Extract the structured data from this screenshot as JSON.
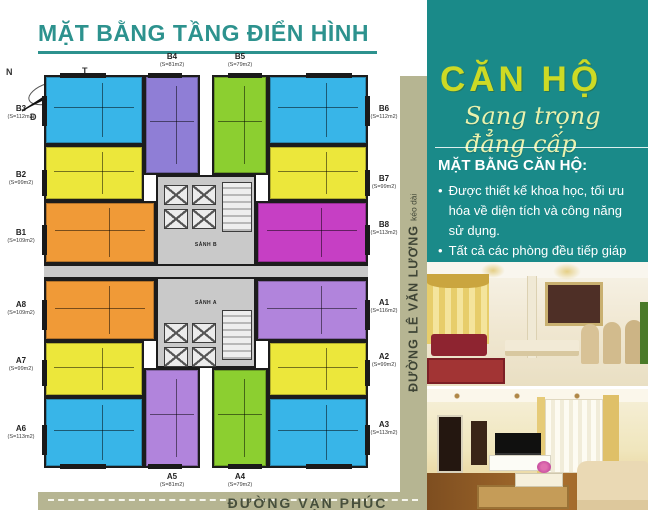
{
  "title": "MẶT BẰNG TẦNG ĐIỂN HÌNH",
  "compass": {
    "top_left": "N",
    "top_right": "T",
    "bottom_left": "Đ",
    "bottom_right": "B"
  },
  "floor_plan": {
    "lobby_b": "SẢNH B",
    "lobby_a": "SẢNH A",
    "units": [
      {
        "id": "B3",
        "area": "(S=112m2)",
        "color": "#38b5e8"
      },
      {
        "id": "B2",
        "area": "(S=99m2)",
        "color": "#ece73b"
      },
      {
        "id": "B1",
        "area": "(S=109m2)",
        "color": "#f09a37"
      },
      {
        "id": "A8",
        "area": "(S=109m2)",
        "color": "#f09a37"
      },
      {
        "id": "A7",
        "area": "(S=99m2)",
        "color": "#ece73b"
      },
      {
        "id": "A6",
        "area": "(S=113m2)",
        "color": "#38b5e8"
      },
      {
        "id": "B4",
        "area": "(S=81m2)",
        "color": "#8f7ed6"
      },
      {
        "id": "B5",
        "area": "(S=79m2)",
        "color": "#8ccf30"
      },
      {
        "id": "B6",
        "area": "(S=112m2)",
        "color": "#38b5e8"
      },
      {
        "id": "B7",
        "area": "(S=99m2)",
        "color": "#ece73b"
      },
      {
        "id": "B8",
        "area": "(S=113m2)",
        "color": "#c63fc4"
      },
      {
        "id": "A1",
        "area": "(S=116m2)",
        "color": "#b184dc"
      },
      {
        "id": "A2",
        "area": "(S=99m2)",
        "color": "#ece73b"
      },
      {
        "id": "A3",
        "area": "(S=113m2)",
        "color": "#38b5e8"
      },
      {
        "id": "A5",
        "area": "(S=81m2)",
        "color": "#b184dc"
      },
      {
        "id": "A4",
        "area": "(S=79m2)",
        "color": "#8ccf30"
      }
    ]
  },
  "streets": {
    "right_name": "ĐƯỜNG LÊ VĂN LƯƠNG",
    "right_suffix": "kéo dài",
    "bottom_name": "ĐƯỜNG VẠN PHÚC"
  },
  "panel": {
    "heading": "CĂN HỘ",
    "tagline": "Sang trọng đẳng cấp",
    "subheading": "MẶT BẰNG CĂN HỘ:",
    "bullet_char": "•",
    "bullets": [
      "Được thiết kế khoa học, tối ưu hóa về diện tích và công năng sử dụng.",
      "Tất cả các phòng đều tiếp giáp ánh sáng tự nhiên, đón gió và khí trời."
    ]
  },
  "colors": {
    "title_teal": "#2d928e",
    "panel_teal": "#1a8a89",
    "heading_yellow": "#cdda25",
    "road_olive": "#b6b592"
  }
}
